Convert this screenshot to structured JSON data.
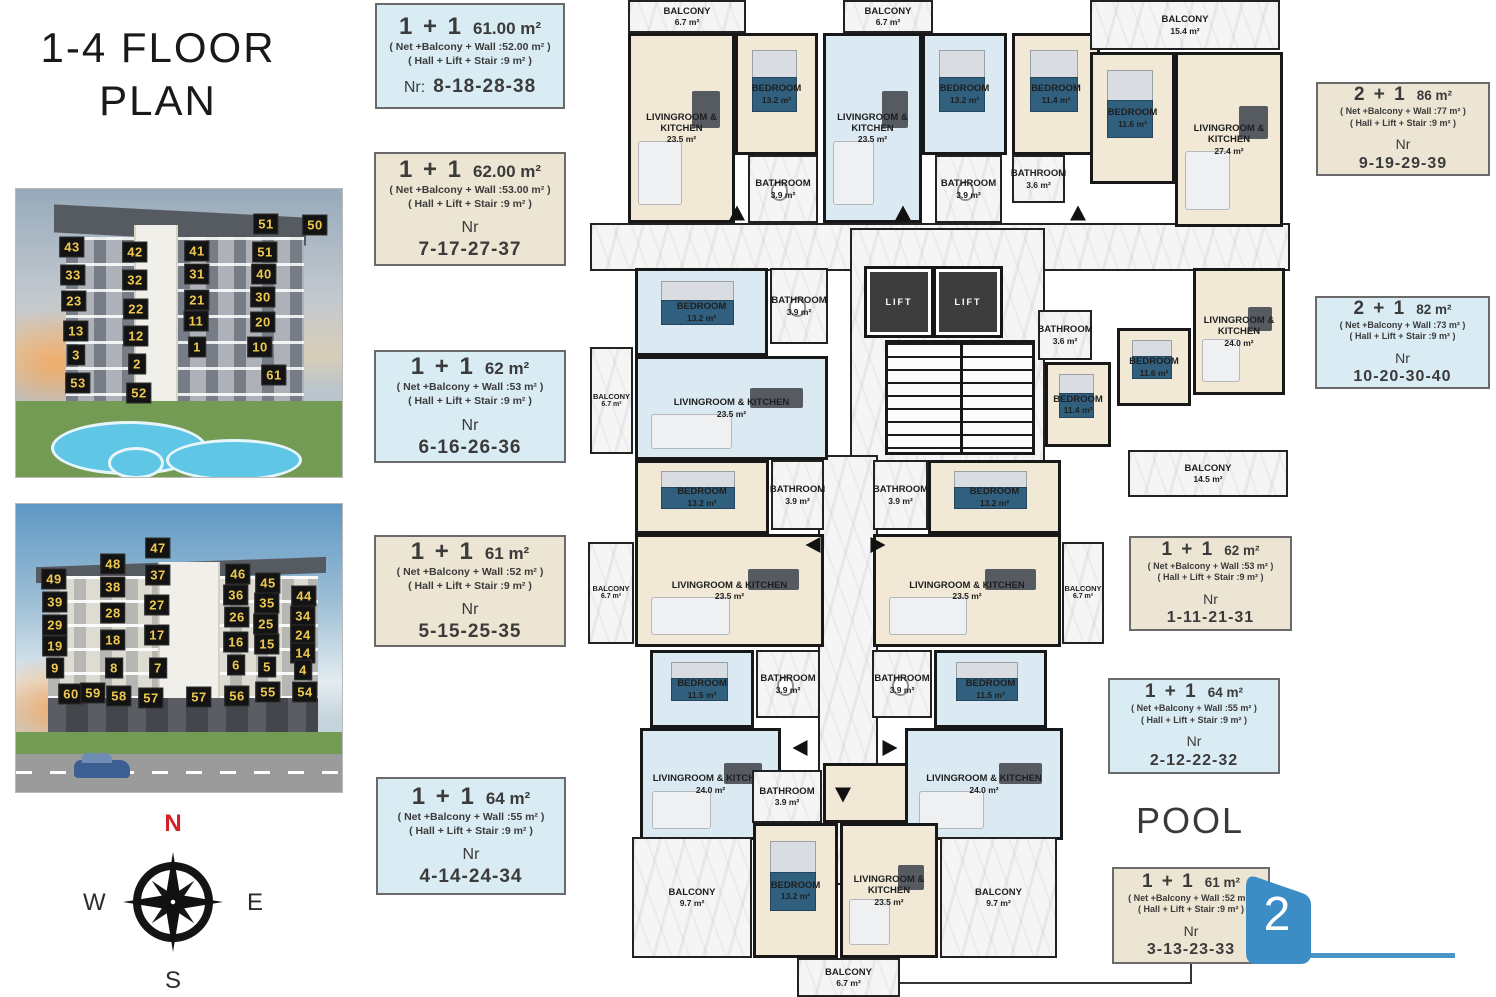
{
  "title": {
    "line1": "1-4 FLOOR",
    "line2": "PLAN"
  },
  "pool_label": "POOL",
  "badge": {
    "number": "2",
    "color": "#3c8dc5"
  },
  "compass": {
    "n": "N",
    "e": "E",
    "s": "S",
    "w": "W"
  },
  "cards": [
    {
      "type": "1 + 1",
      "size": "61.00 m²",
      "line1": "( Net +Balcony + Wall :52.00 m² )",
      "line2": "( Hall + Lift + Stair :9 m² )",
      "nr_label": "Nr:",
      "nr": "8-18-28-38"
    },
    {
      "type": "1 + 1",
      "size": "62.00 m²",
      "line1": "( Net +Balcony + Wall :53.00 m² )",
      "line2": "( Hall + Lift + Stair :9 m² )",
      "nr_label": "Nr",
      "nr": "7-17-27-37"
    },
    {
      "type": "1 + 1",
      "size": "62 m²",
      "line1": "( Net +Balcony + Wall :53 m² )",
      "line2": "( Hall + Lift + Stair :9 m² )",
      "nr_label": "Nr",
      "nr": "6-16-26-36"
    },
    {
      "type": "1 + 1",
      "size": "61 m²",
      "line1": "( Net +Balcony + Wall :52 m² )",
      "line2": "( Hall + Lift + Stair :9 m² )",
      "nr_label": "Nr",
      "nr": "5-15-25-35"
    },
    {
      "type": "1 + 1",
      "size": "64 m²",
      "line1": "( Net +Balcony + Wall :55 m² )",
      "line2": "( Hall + Lift + Stair :9 m² )",
      "nr_label": "Nr",
      "nr": "4-14-24-34"
    },
    {
      "type": "2 + 1",
      "size": "86 m²",
      "line1": "( Net +Balcony + Wall :77 m² )",
      "line2": "( Hall + Lift + Stair :9 m² )",
      "nr_label": "Nr",
      "nr": "9-19-29-39"
    },
    {
      "type": "2 + 1",
      "size": "82 m²",
      "line1": "( Net +Balcony + Wall :73 m² )",
      "line2": "( Hall + Lift + Stair :9 m² )",
      "nr_label": "Nr",
      "nr": "10-20-30-40"
    },
    {
      "type": "1 + 1",
      "size": "62 m²",
      "line1": "( Net +Balcony + Wall :53 m² )",
      "line2": "( Hall + Lift + Stair :9 m² )",
      "nr_label": "Nr",
      "nr": "1-11-21-31"
    },
    {
      "type": "1 + 1",
      "size": "64 m²",
      "line1": "( Net +Balcony + Wall :55 m² )",
      "line2": "( Hall + Lift + Stair :9 m² )",
      "nr_label": "Nr",
      "nr": "2-12-22-32"
    },
    {
      "type": "1 + 1",
      "size": "61 m²",
      "line1": "( Net +Balcony + Wall :52 m² )",
      "line2": "( Hall + Lift + Stair :9 m² )",
      "nr_label": "Nr",
      "nr": "3-13-23-33"
    }
  ],
  "buildings": [
    {
      "labels": [
        {
          "n": "51",
          "x": 250,
          "y": 35
        },
        {
          "n": "50",
          "x": 299,
          "y": 36
        },
        {
          "n": "43",
          "x": 56,
          "y": 58
        },
        {
          "n": "42",
          "x": 119,
          "y": 63
        },
        {
          "n": "41",
          "x": 181,
          "y": 62
        },
        {
          "n": "51",
          "x": 249,
          "y": 63
        },
        {
          "n": "33",
          "x": 57,
          "y": 86
        },
        {
          "n": "32",
          "x": 119,
          "y": 91
        },
        {
          "n": "31",
          "x": 181,
          "y": 85
        },
        {
          "n": "40",
          "x": 248,
          "y": 85
        },
        {
          "n": "23",
          "x": 58,
          "y": 112
        },
        {
          "n": "22",
          "x": 120,
          "y": 120
        },
        {
          "n": "21",
          "x": 181,
          "y": 111
        },
        {
          "n": "30",
          "x": 247,
          "y": 108
        },
        {
          "n": "13",
          "x": 60,
          "y": 142
        },
        {
          "n": "12",
          "x": 120,
          "y": 147
        },
        {
          "n": "11",
          "x": 180,
          "y": 132
        },
        {
          "n": "20",
          "x": 247,
          "y": 133
        },
        {
          "n": "3",
          "x": 60,
          "y": 166
        },
        {
          "n": "2",
          "x": 121,
          "y": 175
        },
        {
          "n": "1",
          "x": 181,
          "y": 158
        },
        {
          "n": "10",
          "x": 244,
          "y": 158
        },
        {
          "n": "53",
          "x": 62,
          "y": 194
        },
        {
          "n": "52",
          "x": 123,
          "y": 204
        },
        {
          "n": "61",
          "x": 258,
          "y": 186
        }
      ]
    },
    {
      "labels": [
        {
          "n": "47",
          "x": 142,
          "y": 44
        },
        {
          "n": "48",
          "x": 97,
          "y": 60
        },
        {
          "n": "37",
          "x": 142,
          "y": 71
        },
        {
          "n": "46",
          "x": 222,
          "y": 70
        },
        {
          "n": "49",
          "x": 38,
          "y": 75
        },
        {
          "n": "38",
          "x": 97,
          "y": 83
        },
        {
          "n": "45",
          "x": 252,
          "y": 79
        },
        {
          "n": "36",
          "x": 220,
          "y": 91
        },
        {
          "n": "39",
          "x": 39,
          "y": 98
        },
        {
          "n": "27",
          "x": 141,
          "y": 101
        },
        {
          "n": "35",
          "x": 251,
          "y": 99
        },
        {
          "n": "44",
          "x": 288,
          "y": 92
        },
        {
          "n": "28",
          "x": 97,
          "y": 109
        },
        {
          "n": "26",
          "x": 221,
          "y": 113
        },
        {
          "n": "34",
          "x": 287,
          "y": 112
        },
        {
          "n": "29",
          "x": 39,
          "y": 121
        },
        {
          "n": "25",
          "x": 250,
          "y": 120
        },
        {
          "n": "18",
          "x": 97,
          "y": 136
        },
        {
          "n": "17",
          "x": 141,
          "y": 131
        },
        {
          "n": "24",
          "x": 287,
          "y": 131
        },
        {
          "n": "19",
          "x": 39,
          "y": 142
        },
        {
          "n": "16",
          "x": 220,
          "y": 138
        },
        {
          "n": "15",
          "x": 251,
          "y": 140
        },
        {
          "n": "14",
          "x": 287,
          "y": 149
        },
        {
          "n": "9",
          "x": 39,
          "y": 164
        },
        {
          "n": "8",
          "x": 98,
          "y": 164
        },
        {
          "n": "7",
          "x": 142,
          "y": 164
        },
        {
          "n": "6",
          "x": 220,
          "y": 161
        },
        {
          "n": "5",
          "x": 251,
          "y": 163
        },
        {
          "n": "4",
          "x": 287,
          "y": 166
        },
        {
          "n": "60",
          "x": 55,
          "y": 190
        },
        {
          "n": "59",
          "x": 77,
          "y": 189
        },
        {
          "n": "58",
          "x": 103,
          "y": 192
        },
        {
          "n": "57",
          "x": 135,
          "y": 194
        },
        {
          "n": "57",
          "x": 183,
          "y": 193
        },
        {
          "n": "56",
          "x": 221,
          "y": 192
        },
        {
          "n": "55",
          "x": 252,
          "y": 188
        },
        {
          "n": "54",
          "x": 289,
          "y": 188
        }
      ]
    }
  ],
  "floorplan": {
    "rooms": [
      {
        "name": "",
        "area": "",
        "x": 590,
        "y": 223,
        "w": 700,
        "h": 48,
        "fill": "marble"
      },
      {
        "name": "",
        "area": "",
        "x": 850,
        "y": 228,
        "w": 195,
        "h": 235,
        "fill": "marble"
      },
      {
        "name": "",
        "area": "",
        "x": 818,
        "y": 455,
        "w": 60,
        "h": 430,
        "fill": "marble"
      },
      {
        "name": "",
        "area": "",
        "x": 823,
        "y": 763,
        "w": 100,
        "h": 60,
        "fill": "cream"
      },
      {
        "name": "BALCONY",
        "area": "6.7 m²",
        "x": 628,
        "y": 0,
        "w": 118,
        "h": 33,
        "fill": "marble"
      },
      {
        "name": "LIVINGROOM & KITCHEN",
        "area": "23.5 m²",
        "x": 628,
        "y": 33,
        "w": 107,
        "h": 190,
        "fill": "cream",
        "type": "living"
      },
      {
        "name": "BEDROOM",
        "area": "13.2 m²",
        "x": 735,
        "y": 33,
        "w": 83,
        "h": 122,
        "fill": "cream",
        "type": "bedroom"
      },
      {
        "name": "BATHROOM",
        "area": "3.9 m²",
        "x": 748,
        "y": 155,
        "w": 70,
        "h": 68,
        "fill": "marble",
        "type": "bath"
      },
      {
        "name": "BALCONY",
        "area": "6.7 m²",
        "x": 843,
        "y": 0,
        "w": 90,
        "h": 33,
        "fill": "marble"
      },
      {
        "name": "LIVINGROOM & KITCHEN",
        "area": "23.5 m²",
        "x": 823,
        "y": 33,
        "w": 99,
        "h": 190,
        "fill": "blue",
        "type": "living"
      },
      {
        "name": "BEDROOM",
        "area": "13.2 m²",
        "x": 922,
        "y": 33,
        "w": 85,
        "h": 122,
        "fill": "blue",
        "type": "bedroom"
      },
      {
        "name": "BATHROOM",
        "area": "3.9 m²",
        "x": 935,
        "y": 155,
        "w": 67,
        "h": 68,
        "fill": "marble",
        "type": "bath"
      },
      {
        "name": "BEDROOM",
        "area": "11.4 m²",
        "x": 1012,
        "y": 33,
        "w": 88,
        "h": 122,
        "fill": "cream",
        "type": "bedroom"
      },
      {
        "name": "BATHROOM",
        "area": "3.6 m²",
        "x": 1012,
        "y": 155,
        "w": 53,
        "h": 48,
        "fill": "marble"
      },
      {
        "name": "BALCONY",
        "area": "15.4 m²",
        "x": 1090,
        "y": 0,
        "w": 190,
        "h": 50,
        "fill": "marble"
      },
      {
        "name": "BEDROOM",
        "area": "11.6 m²",
        "x": 1090,
        "y": 52,
        "w": 85,
        "h": 132,
        "fill": "cream",
        "type": "bedroom"
      },
      {
        "name": "LIVINGROOM & KITCHEN",
        "area": "27.4 m²",
        "x": 1175,
        "y": 52,
        "w": 108,
        "h": 175,
        "fill": "cream",
        "type": "living"
      },
      {
        "name": "BALCONY",
        "area": "6.7 m²",
        "x": 590,
        "y": 347,
        "w": 43,
        "h": 107,
        "fill": "marble"
      },
      {
        "name": "BEDROOM",
        "area": "13.2 m²",
        "x": 635,
        "y": 268,
        "w": 133,
        "h": 88,
        "fill": "blue",
        "type": "bedroom"
      },
      {
        "name": "BATHROOM",
        "area": "3.9 m²",
        "x": 770,
        "y": 268,
        "w": 58,
        "h": 76,
        "fill": "marble",
        "type": "bath"
      },
      {
        "name": "LIVINGROOM & KITCHEN",
        "area": "23.5 m²",
        "x": 635,
        "y": 356,
        "w": 193,
        "h": 104,
        "fill": "blue",
        "type": "living"
      },
      {
        "name": "LIFT",
        "area": "",
        "x": 870,
        "y": 272,
        "w": 58,
        "h": 60,
        "fill": "dark"
      },
      {
        "name": "LIFT",
        "area": "",
        "x": 939,
        "y": 272,
        "w": 58,
        "h": 60,
        "fill": "dark"
      },
      {
        "name": "",
        "area": "",
        "x": 885,
        "y": 340,
        "w": 150,
        "h": 115,
        "fill": "stairs"
      },
      {
        "name": "BATHROOM",
        "area": "3.6 m²",
        "x": 1038,
        "y": 310,
        "w": 54,
        "h": 50,
        "fill": "marble"
      },
      {
        "name": "BEDROOM",
        "area": "11.4 m²",
        "x": 1045,
        "y": 362,
        "w": 66,
        "h": 85,
        "fill": "cream",
        "type": "bedroom"
      },
      {
        "name": "BEDROOM",
        "area": "11.6 m²",
        "x": 1117,
        "y": 328,
        "w": 74,
        "h": 78,
        "fill": "cream",
        "type": "bedroom"
      },
      {
        "name": "LIVINGROOM & KITCHEN",
        "area": "24.0 m²",
        "x": 1193,
        "y": 268,
        "w": 92,
        "h": 127,
        "fill": "cream",
        "type": "living"
      },
      {
        "name": "BALCONY",
        "area": "14.5 m²",
        "x": 1128,
        "y": 450,
        "w": 160,
        "h": 47,
        "fill": "marble"
      },
      {
        "name": "BEDROOM",
        "area": "13.2 m²",
        "x": 635,
        "y": 460,
        "w": 134,
        "h": 74,
        "fill": "cream",
        "type": "bedroom"
      },
      {
        "name": "BATHROOM",
        "area": "3.9 m²",
        "x": 771,
        "y": 460,
        "w": 53,
        "h": 70,
        "fill": "marble",
        "type": "bath"
      },
      {
        "name": "LIVINGROOM & KITCHEN",
        "area": "23.5 m²",
        "x": 635,
        "y": 534,
        "w": 189,
        "h": 113,
        "fill": "cream",
        "type": "living"
      },
      {
        "name": "BALCONY",
        "area": "6.7 m²",
        "x": 588,
        "y": 542,
        "w": 46,
        "h": 102,
        "fill": "marble"
      },
      {
        "name": "BATHROOM",
        "area": "3.9 m²",
        "x": 873,
        "y": 460,
        "w": 55,
        "h": 70,
        "fill": "marble",
        "type": "bath"
      },
      {
        "name": "BEDROOM",
        "area": "13.2 m²",
        "x": 928,
        "y": 460,
        "w": 133,
        "h": 74,
        "fill": "cream",
        "type": "bedroom"
      },
      {
        "name": "LIVINGROOM & KITCHEN",
        "area": "23.5 m²",
        "x": 873,
        "y": 534,
        "w": 188,
        "h": 113,
        "fill": "cream",
        "type": "living"
      },
      {
        "name": "BALCONY",
        "area": "6.7 m²",
        "x": 1062,
        "y": 542,
        "w": 42,
        "h": 102,
        "fill": "marble"
      },
      {
        "name": "BEDROOM",
        "area": "11.5 m²",
        "x": 650,
        "y": 650,
        "w": 104,
        "h": 78,
        "fill": "blue",
        "type": "bedroom"
      },
      {
        "name": "BATHROOM",
        "area": "3.9 m²",
        "x": 756,
        "y": 650,
        "w": 64,
        "h": 68,
        "fill": "marble",
        "type": "bath"
      },
      {
        "name": "LIVINGROOM & KITCHEN",
        "area": "24.0 m²",
        "x": 640,
        "y": 728,
        "w": 141,
        "h": 112,
        "fill": "blue",
        "type": "living"
      },
      {
        "name": "BATHROOM",
        "area": "3.9 m²",
        "x": 872,
        "y": 650,
        "w": 60,
        "h": 68,
        "fill": "marble",
        "type": "bath"
      },
      {
        "name": "BEDROOM",
        "area": "11.5 m²",
        "x": 934,
        "y": 650,
        "w": 113,
        "h": 78,
        "fill": "blue",
        "type": "bedroom"
      },
      {
        "name": "LIVINGROOM & KITCHEN",
        "area": "24.0 m²",
        "x": 905,
        "y": 728,
        "w": 158,
        "h": 112,
        "fill": "blue",
        "type": "living"
      },
      {
        "name": "BATHROOM",
        "area": "3.9 m²",
        "x": 752,
        "y": 770,
        "w": 70,
        "h": 53,
        "fill": "marble",
        "type": "bath"
      },
      {
        "name": "BEDROOM",
        "area": "13.2 m²",
        "x": 753,
        "y": 823,
        "w": 85,
        "h": 135,
        "fill": "cream",
        "type": "bedroom"
      },
      {
        "name": "LIVINGROOM & KITCHEN",
        "area": "23.5 m²",
        "x": 840,
        "y": 823,
        "w": 98,
        "h": 135,
        "fill": "cream",
        "type": "living"
      },
      {
        "name": "BALCONY",
        "area": "9.7 m²",
        "x": 632,
        "y": 837,
        "w": 120,
        "h": 121,
        "fill": "marble"
      },
      {
        "name": "BALCONY",
        "area": "9.7 m²",
        "x": 940,
        "y": 837,
        "w": 117,
        "h": 121,
        "fill": "marble"
      },
      {
        "name": "BALCONY",
        "area": "6.7 m²",
        "x": 797,
        "y": 958,
        "w": 103,
        "h": 39,
        "fill": "marble"
      }
    ],
    "arrows": [
      {
        "x": 737,
        "y": 213,
        "d": "up"
      },
      {
        "x": 903,
        "y": 213,
        "d": "up"
      },
      {
        "x": 1078,
        "y": 213,
        "d": "up"
      },
      {
        "x": 813,
        "y": 545,
        "d": "left"
      },
      {
        "x": 878,
        "y": 545,
        "d": "right"
      },
      {
        "x": 800,
        "y": 748,
        "d": "left"
      },
      {
        "x": 890,
        "y": 748,
        "d": "right"
      },
      {
        "x": 843,
        "y": 795,
        "d": "down"
      }
    ],
    "lines": [
      {
        "x": 900,
        "y": 982,
        "w": 292,
        "h": 2,
        "c": "#333333"
      },
      {
        "x": 1190,
        "y": 962,
        "w": 2,
        "h": 22,
        "c": "#333333"
      },
      {
        "x": 1237,
        "y": 953,
        "w": 218,
        "h": 5,
        "c": "#4a94c8"
      }
    ]
  }
}
